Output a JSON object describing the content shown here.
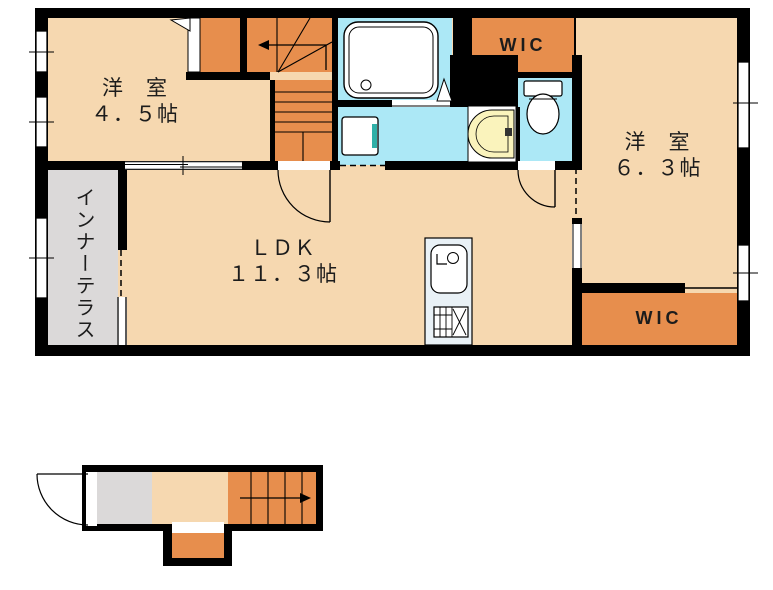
{
  "colors": {
    "floor": "#F6D8B0",
    "accent": "#E78E4D",
    "wet": "#ACE8F6",
    "terrace": "#DBD9D9",
    "basin": "#FAF3BC",
    "counter": "#E9F1F6",
    "pan-accent": "#2FB0A8",
    "wall": "#000000",
    "text": "#1C1C1C",
    "bg": "#FFFFFF"
  },
  "rooms": {
    "western_room_1": {
      "label": "洋　室",
      "size": "４．５帖"
    },
    "ldk": {
      "label": "ＬＤＫ",
      "size": "１１．３帖"
    },
    "western_room_2": {
      "label": "洋　室",
      "size": "６．３帖"
    },
    "wic_upper": {
      "label": "WIC"
    },
    "wic_lower": {
      "label": "WIC"
    },
    "inner_terrace": {
      "label": "インナーテラス"
    }
  }
}
